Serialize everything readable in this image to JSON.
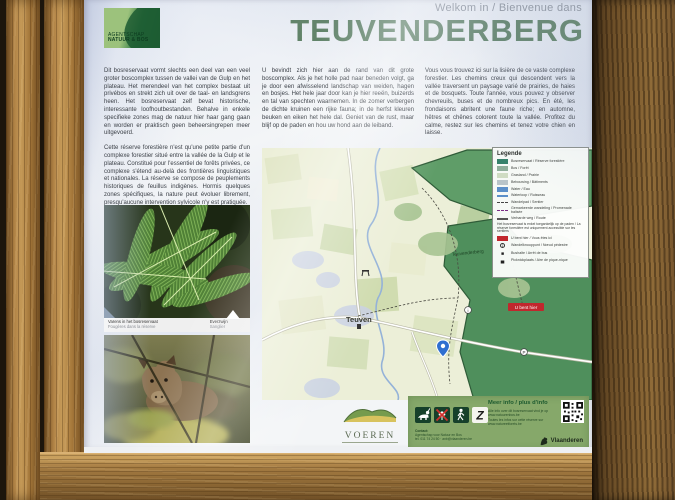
{
  "header": {
    "welcome": "Welkom in / Bienvenue dans",
    "title": "TEUVENDERBERG"
  },
  "logo": {
    "line1": "AGENTSCHAP",
    "line2": "NATUUR & BOS"
  },
  "intro": {
    "nl_1": "Dit bosreservaat vormt slechts een deel van een veel groter boscomplex tussen de vallei van de Gulp en het plateau. Het merendeel van het complex bestaat uit privébos en strekt zich uit over de taal- en landsgrens heen. Het bosreservaat zelf bevat historische, interessante loofhoutbestanden. Behalve in enkele specifieke zones mag de natuur hier haar gang gaan en worden er praktisch geen beheersingrepen meer uitgevoerd.",
    "fr_1": "Cette réserve forestière n'est qu'une petite partie d'un complexe forestier situé entre la vallée de la Gulp et le plateau. Constitué pour l'essentiel de forêts privées, ce complexe s'étend au-delà des frontières linguistiques et nationales. La réserve se compose de peuplements historiques de feuillus indigènes. Hormis quelques zones spécifiques, la nature peut évoluer librement, presqu'aucune intervention sylvicole n'y est pratiquée.",
    "nl_2": "U bevindt zich hier aan de rand van dit grote boscomplex. Als je het holle pad naar beneden volgt, ga je door een afwisselend landschap van weiden, hagen en bosjes. Het hele jaar door kan je hier reeën, buizerds en tal van spechten waarnemen. In de zomer verbergen de dichte kruinen een rijke fauna; in de herfst kleuren beuken en eiken het hele dal. Geniet van de rust, maar blijf op de paden en hou uw hond aan de leiband.",
    "fr_2": "Vous vous trouvez ici sur la lisière de ce vaste complexe forestier. Les chemins creux qui descendent vers la vallée traversent un paysage varié de prairies, de haies et de bosquets. Toute l'année, vous pouvez y observer chevreuils, buses et de nombreux pics. En été, les frondaisons abritent une faune riche; en automne, hêtres et chênes colorent toute la vallée. Profitez du calme, restez sur les chemins et tenez votre chien en laisse."
  },
  "photos": {
    "fern_caption": "Varens in het bosreservaat",
    "fern_caption_sub": "Fougères dans la réserve",
    "boar_caption": "Everzwijn",
    "boar_caption_sub": "Sanglier"
  },
  "map": {
    "labels": {
      "village": "Teuven",
      "forest": "Teuvenderberg",
      "you_are_here": "U bent hier"
    }
  },
  "legend": {
    "title": "Legende",
    "items": [
      {
        "label": "Bosreservaat / Réserve forestière"
      },
      {
        "label": "Bos / Forêt"
      },
      {
        "label": "Grasland / Prairie"
      },
      {
        "label": "Bebouwing / Bâtiments"
      },
      {
        "label": "Water / Eau"
      },
      {
        "label": "Waterloop / Ruisseau"
      },
      {
        "label": "Wandelpad / Sentier"
      },
      {
        "label": "Gemarkeerde wandeling / Promenade balisée"
      },
      {
        "label": "Verharde weg / Route"
      },
      {
        "label": "Het bosreservaat is enkel toegankelijk op de paden / La réserve forestière est uniquement accessible sur les sentiers"
      },
      {
        "label": "U bent hier / Vous êtes ici"
      },
      {
        "label": "Wandelknooppunt / Nœud pédestre"
      },
      {
        "label": "Bushalte / Arrêt de bus"
      },
      {
        "label": "Picknickplaats / Aire de pique-nique"
      }
    ]
  },
  "info_bar": {
    "heading": "Meer info / plus d'info",
    "line1": "Alle info over dit bosreservaat vind je op www.natuurenbos.be",
    "line2": "Toutes les infos sur cette réserve sur www.natureetforets.be",
    "contact_label": "Contact:",
    "contact1": "Agentschap voor Natuur en Bos",
    "contact2": "tel. 011 74 24 50  ·  anb@vlaanderen.be"
  },
  "brand": {
    "region": "Vlaanderen",
    "municipality": "VOEREN"
  },
  "pictograms": [
    {
      "name": "dog-on-leash"
    },
    {
      "name": "no-picking"
    },
    {
      "name": "pedestrians-only"
    },
    {
      "name": "route-marker-z"
    }
  ],
  "colors": {
    "title_green": "#5d8063",
    "forest_dark": "#4f8f5c",
    "forest_band": "#5f9d68",
    "map_bg": "#ecefd8",
    "info_bar_green": "#86a86a",
    "you_are_here_red": "#c1272d",
    "wood_light": "#b8894a",
    "wood_dark": "#6f4f26"
  }
}
